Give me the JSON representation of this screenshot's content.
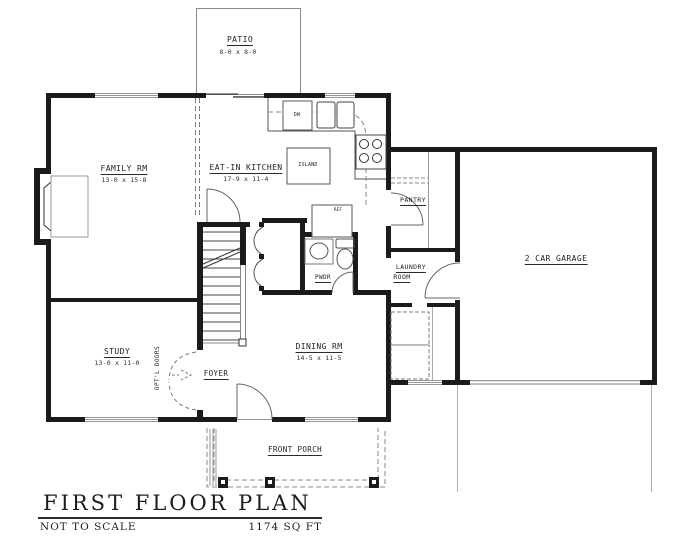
{
  "title_block": {
    "title": "FIRST FLOOR PLAN",
    "scale_note": "NOT TO SCALE",
    "area": "1174 SQ FT"
  },
  "rooms": {
    "patio": {
      "name": "PATIO",
      "dims": "8-0 x 8-0"
    },
    "family": {
      "name": "FAMILY RM",
      "dims": "13-0 x 15-8"
    },
    "kitchen": {
      "name": "EAT-IN KITCHEN",
      "dims": "17-9 x 11-4"
    },
    "pantry": {
      "name": "PANTRY"
    },
    "laundry": {
      "name_line1": "LAUNDRY",
      "name_line2": "ROOM"
    },
    "garage": {
      "name": "2 CAR GARAGE"
    },
    "powder": {
      "name": "PWDR"
    },
    "study": {
      "name": "STUDY",
      "dims": "13-0 x 11-0"
    },
    "foyer": {
      "name": "FOYER"
    },
    "dining": {
      "name": "DINING RM",
      "dims": "14-5 x 11-5"
    },
    "porch": {
      "name": "FRONT PORCH"
    }
  },
  "fixtures": {
    "island": "ISLAND",
    "dishwasher": "DW",
    "refrigerator": "REF",
    "optional_doors": "OPT'L DOORS"
  },
  "colors": {
    "wall": "#1b1b1b",
    "thin_line": "#555555",
    "window_line": "#979797",
    "dashed_line": "#808080",
    "text": "#1f1f1f"
  }
}
